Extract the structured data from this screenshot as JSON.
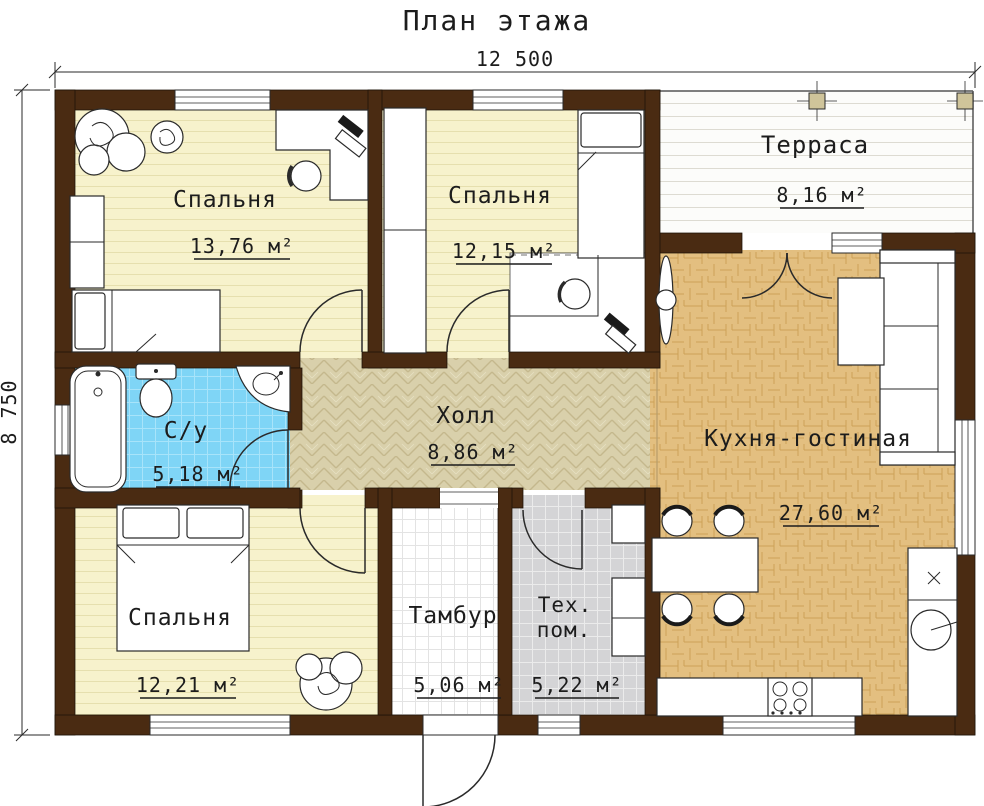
{
  "title": "План этажа",
  "dimensions": {
    "width_label": "12 500",
    "height_label": "8 750"
  },
  "rooms": {
    "bedroom1": {
      "label": "Спальня",
      "area": "13,76 м²"
    },
    "bedroom2": {
      "label": "Спальня",
      "area": "12,15 м²"
    },
    "terrace": {
      "label": "Терраса",
      "area": "8,16 м²"
    },
    "bathroom": {
      "label": "С/у",
      "area": "5,18 м²"
    },
    "hall": {
      "label": "Холл",
      "area": "8,86 м²"
    },
    "kitchen_living": {
      "label": "Кухня-гостиная",
      "area": "27,60 м²"
    },
    "bedroom3": {
      "label": "Спальня",
      "area": "12,21 м²"
    },
    "vestibule": {
      "label": "Тамбур",
      "area": "5,06 м²"
    },
    "tech_room": {
      "label_line1": "Тех.",
      "label_line2": "пом.",
      "area": "5,22 м²"
    }
  },
  "colors": {
    "wall": "#4a2b12",
    "bedroom_floor": "#f7f2cc",
    "hall_floor": "#d9d0ab",
    "kitchen_floor": "#e3bf80",
    "bathroom_floor": "#7fd5f6",
    "tech_floor": "#d4d4d6",
    "vestibule_floor": "#ffffff",
    "terrace_floor": "#fcfcfa"
  }
}
